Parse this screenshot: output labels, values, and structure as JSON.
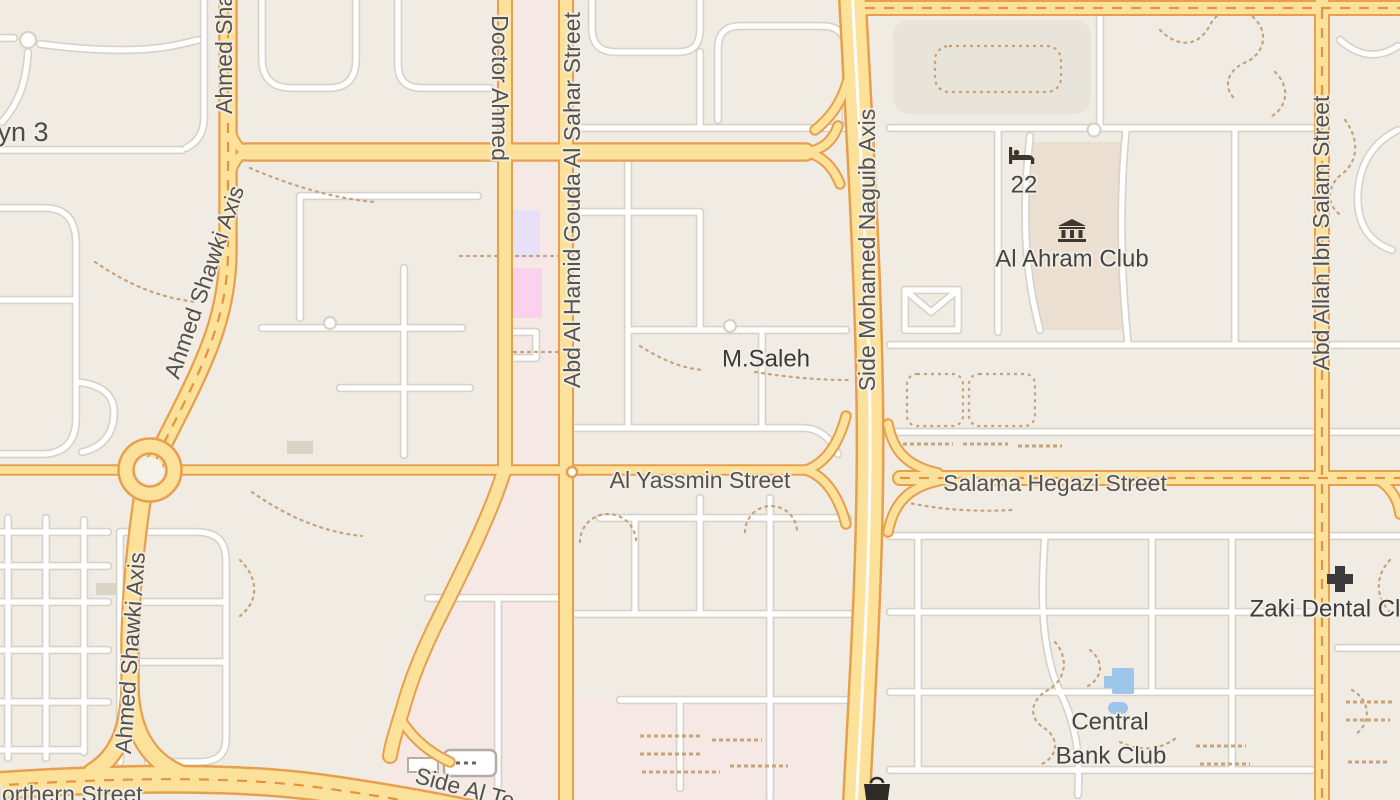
{
  "map": {
    "place_labels": [
      {
        "id": "district-partial",
        "text": "yn 3"
      },
      {
        "id": "m-saleh",
        "text": "M.Saleh"
      },
      {
        "id": "hotel-number",
        "text": "22"
      },
      {
        "id": "al-ahram-club",
        "text": "Al Ahram Club"
      },
      {
        "id": "zaki-dental-clinic",
        "text": "Zaki Dental Cl"
      },
      {
        "id": "central-bank-club-line1",
        "text": "Central"
      },
      {
        "id": "central-bank-club-line2",
        "text": "Bank Club"
      }
    ],
    "street_labels": [
      {
        "id": "ahmed-shawki-axis-top",
        "text": "Ahmed Shawki Axis"
      },
      {
        "id": "ahmed-shawki-axis-diagonal",
        "text": "Ahmed Shawki Axis"
      },
      {
        "id": "ahmed-shawki-axis-south",
        "text": "Ahmed Shawki Axis"
      },
      {
        "id": "doctor-ahmed",
        "text": "Doctor Ahmed"
      },
      {
        "id": "abd-al-hamid-gouda",
        "text": "Abd Al Hamid Gouda Al Sahar Street"
      },
      {
        "id": "al-yassmin",
        "text": "Al Yassmin Street"
      },
      {
        "id": "side-mohamed-naguib",
        "text": "Side Mohamed Naguib Axis"
      },
      {
        "id": "salama-hegazi",
        "text": "Salama Hegazi Street"
      },
      {
        "id": "abd-allah-ibn-salam",
        "text": "Abd Allah Ibn Salam Street"
      },
      {
        "id": "northern",
        "text": "Northern Street"
      },
      {
        "id": "side-al-te",
        "text": "Side Al Te"
      }
    ],
    "icons": {
      "hotel": "bed-icon",
      "museum": "museum-icon",
      "dental_clinic": "cross-icon",
      "waste_basket": "waste-basket-icon"
    },
    "colors": {
      "background": "#f0ece3",
      "road_major_fill": "#fce19a",
      "road_major_casing": "#e89f4d",
      "road_minor_fill": "#ffffff",
      "road_minor_casing": "#d6d2c8",
      "retail_area": "#f6e8e4",
      "club_area": "#ebdfd2",
      "sports_block": "#e9e4d9",
      "lavender_building": "#e7e0f6",
      "pink_building": "#fbd2ee",
      "pool_blue": "#9ec5ea",
      "dotted_path": "#c7a17b",
      "place_label": "#454545",
      "road_label": "#55524b"
    }
  }
}
